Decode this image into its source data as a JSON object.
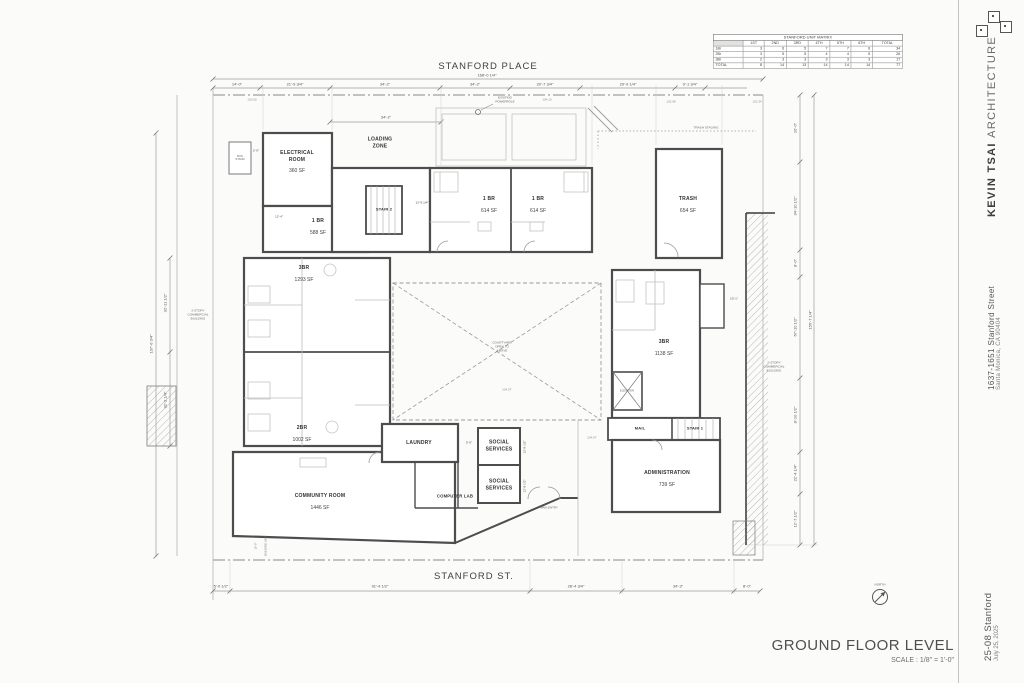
{
  "sheet": {
    "title": "GROUND FLOOR LEVEL",
    "scale": "SCALE : 1/8\" = 1'-0\"",
    "north_label": "NORTH"
  },
  "titleblock": {
    "firm_bold": "KEVIN TSAI",
    "firm_light": "ARCHITECTURE",
    "address_line1": "1637-1651 Stanford Street",
    "address_line2": "Santa Monica, CA 90404",
    "project_number": "25-08 Stanford",
    "date": "July 25, 2025"
  },
  "streets": {
    "top": "STANFORD PLACE",
    "bottom": "STANFORD ST."
  },
  "matrix": {
    "title": "STANFORD UNIT MATRIX",
    "headers": [
      "",
      "1ST",
      "2ND",
      "3RD",
      "4TH",
      "5TH",
      "6TH",
      "TOTAL"
    ],
    "rows": [
      [
        "1Br",
        "3",
        "6",
        "5",
        "7",
        "7",
        "6",
        "34"
      ],
      [
        "2Br",
        "3",
        "5",
        "5",
        "4",
        "4",
        "5",
        "26"
      ],
      [
        "3Br",
        "2",
        "3",
        "3",
        "3",
        "3",
        "3",
        "17"
      ],
      [
        "TOTAL",
        "8",
        "14",
        "13",
        "14",
        "14",
        "14",
        "77"
      ]
    ]
  },
  "rooms": {
    "electrical": {
      "name": "ELECTRICAL ROOM",
      "area": "360 SF"
    },
    "loading_zone": "LOADING ZONE",
    "stair2": "STAIR 2",
    "unit_1br_a": {
      "name": "1 BR",
      "area": "588 SF"
    },
    "unit_1br_b": {
      "name": "1 BR",
      "area": "614 SF"
    },
    "unit_1br_c": {
      "name": "1 BR",
      "area": "614 SF"
    },
    "trash": {
      "name": "TRASH",
      "area": "654 SF"
    },
    "trash_staging": "TRASH STAGING",
    "unit_3br_left": {
      "name": "3BR",
      "area": "1293 SF"
    },
    "unit_2br": {
      "name": "2BR",
      "area": "1002 SF"
    },
    "unit_3br_right": {
      "name": "3BR",
      "area": "1138 SF"
    },
    "elevator": "ELEVATOR",
    "community": {
      "name": "COMMUNITY ROOM",
      "area": "1446 SF"
    },
    "laundry": "LAUNDRY",
    "social_services_1": "SOCIAL SERVICES",
    "social_services_2": "SOCIAL SERVICES",
    "computer_lab": "COMPUTER LAB",
    "mail": "MAIL",
    "stair1": "STAIR 1",
    "admin": {
      "name": "ADMINISTRATION",
      "area": "739 SF"
    },
    "courtyard": "COURTYARD OPEN TO ABOVE",
    "commercial_left": "2-STORY COMMERCIAL BUILDING",
    "commercial_right": "2-STORY COMMERCIAL BUILDING",
    "bus_stand": "BUS STAND",
    "main_entry": "MAIN ENTRY"
  },
  "annotations": {
    "powerpole": "EXISTING POWERPOLE",
    "building_line": "BUILDING LINE",
    "building_line_dim": "10'-0\"",
    "spot_elevations": [
      "100.00",
      "104.10",
      "102.98",
      "102.34",
      "104.07'",
      "104.67'"
    ]
  },
  "dims": {
    "top": [
      "14'-0\"",
      "21'-9 3/4\"",
      "34'-2\"",
      "34'-2\"",
      "20'-7 3/4\"",
      "29'-9 1/4\"",
      "9'-1 3/4\""
    ],
    "top_overall": "168'-0 1/4\"",
    "top_secondary": "34'-2\"",
    "bottom": [
      "5'-0 1/2\"",
      "91'-4 1/2\"",
      "28'-4 3/4\"",
      "34'-3\"",
      "8'-0\""
    ],
    "right": [
      "10'-0\"",
      "34'-10 1/2\"",
      "8'-0\"",
      "67'-10 1/2\"",
      "8'-10 1/2\"",
      "22'-4 1/4\"",
      "12'-7 1/2\""
    ],
    "right_overall": "155'-7 1/4\"",
    "left": [
      "32'-11 1/2\"",
      "32'-2 1/4\""
    ],
    "left_overall": "137'-6 3/4\"",
    "interior": {
      "stair2_w": "12'-9 1/4\"",
      "elec_w": "12'-4\"",
      "bus": "2'-0\"",
      "corridor": "5'-0\"",
      "ss1": "12'-8 1/2\"",
      "ss2": "12'-8 1/2\"",
      "right3br": "10'-1\""
    }
  }
}
